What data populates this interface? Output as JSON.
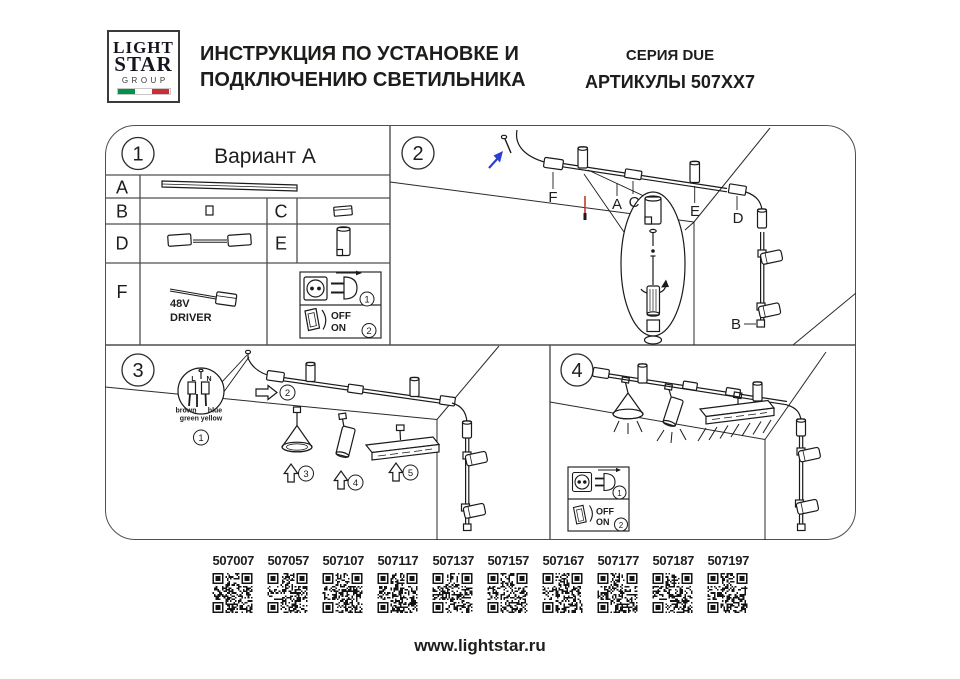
{
  "header": {
    "logo": {
      "line1": "LIGHT",
      "line2": "STAR",
      "line3": "GROUP"
    },
    "title_line1": "ИНСТРУКЦИЯ ПО УСТАНОВКЕ И",
    "title_line2": "ПОДКЛЮЧЕНИЮ СВЕТИЛЬНИКА",
    "series": "СЕРИЯ DUE",
    "articles_label": "АРТИКУЛЫ 507ХХ7"
  },
  "panel1": {
    "number": "1",
    "title": "Вариант А",
    "row_a": "A",
    "row_b": "B",
    "row_c": "C",
    "row_d": "D",
    "row_e": "E",
    "row_f": "F",
    "driver_line1": "48V",
    "driver_line2": "DRIVER",
    "plug_step": "1",
    "switch_off": "OFF",
    "switch_on": "ON",
    "switch_step": "2"
  },
  "panel2": {
    "number": "2",
    "label_f": "F",
    "label_a": "A",
    "label_c": "C",
    "label_e": "E",
    "label_d": "D",
    "label_b": "B"
  },
  "panel3": {
    "number": "3",
    "wire_l": "L",
    "wire_n": "N",
    "wire_brown": "brown",
    "wire_blue": "blue",
    "wire_green_yellow": "green yellow",
    "step1": "1",
    "step2": "2",
    "step3": "3",
    "step4": "4",
    "step5": "5"
  },
  "panel4": {
    "number": "4",
    "plug_step": "1",
    "switch_off": "OFF",
    "switch_on": "ON",
    "switch_step": "2"
  },
  "articles": [
    "507007",
    "507057",
    "507107",
    "507117",
    "507137",
    "507157",
    "507167",
    "507177",
    "507187",
    "507197"
  ],
  "footer": {
    "url": "www.lightstar.ru"
  },
  "colors": {
    "ink": "#1d1d1b",
    "grid": "#4f4f4f",
    "accent_blue": "#2b3fd1",
    "accent_red": "#c0392b",
    "flag_green": "#009246",
    "flag_white": "#ffffff",
    "flag_red": "#ce2b37"
  }
}
